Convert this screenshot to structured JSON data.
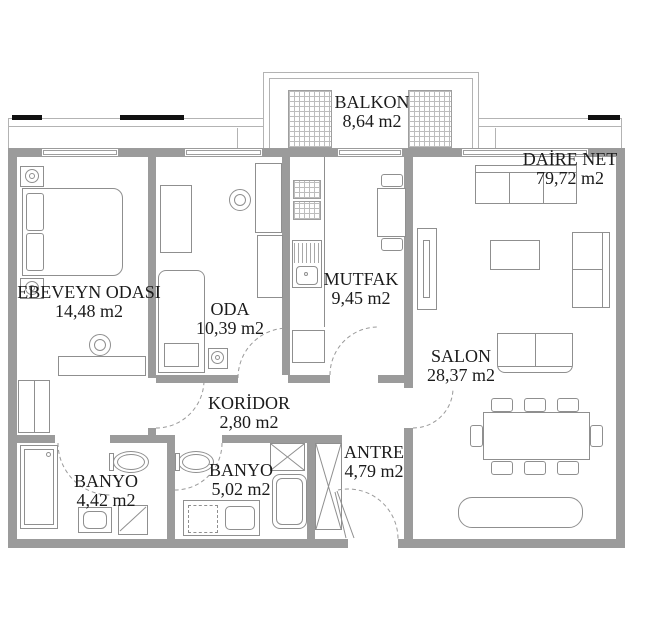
{
  "colors": {
    "wall": "#9b9b9b",
    "line": "#8f8f8f",
    "text": "#1b1b1b"
  },
  "rooms": {
    "balkon": {
      "name": "BALKON",
      "area": "8,64 m2"
    },
    "daire_net": {
      "name": "DAİRE NET",
      "area": "79,72 m2"
    },
    "ebeveyn": {
      "name": "EBEVEYN ODASI",
      "area": "14,48 m2"
    },
    "oda": {
      "name": "ODA",
      "area": "10,39 m2"
    },
    "mutfak": {
      "name": "MUTFAK",
      "area": "9,45 m2"
    },
    "salon": {
      "name": "SALON",
      "area": "28,37 m2"
    },
    "koridor": {
      "name": "KORİDOR",
      "area": "2,80 m2"
    },
    "antre": {
      "name": "ANTRE",
      "area": "4,79 m2"
    },
    "banyo_ebeveyn": {
      "name": "BANYO",
      "area": "4,42 m2"
    },
    "banyo": {
      "name": "BANYO",
      "area": "5,02 m2"
    }
  }
}
